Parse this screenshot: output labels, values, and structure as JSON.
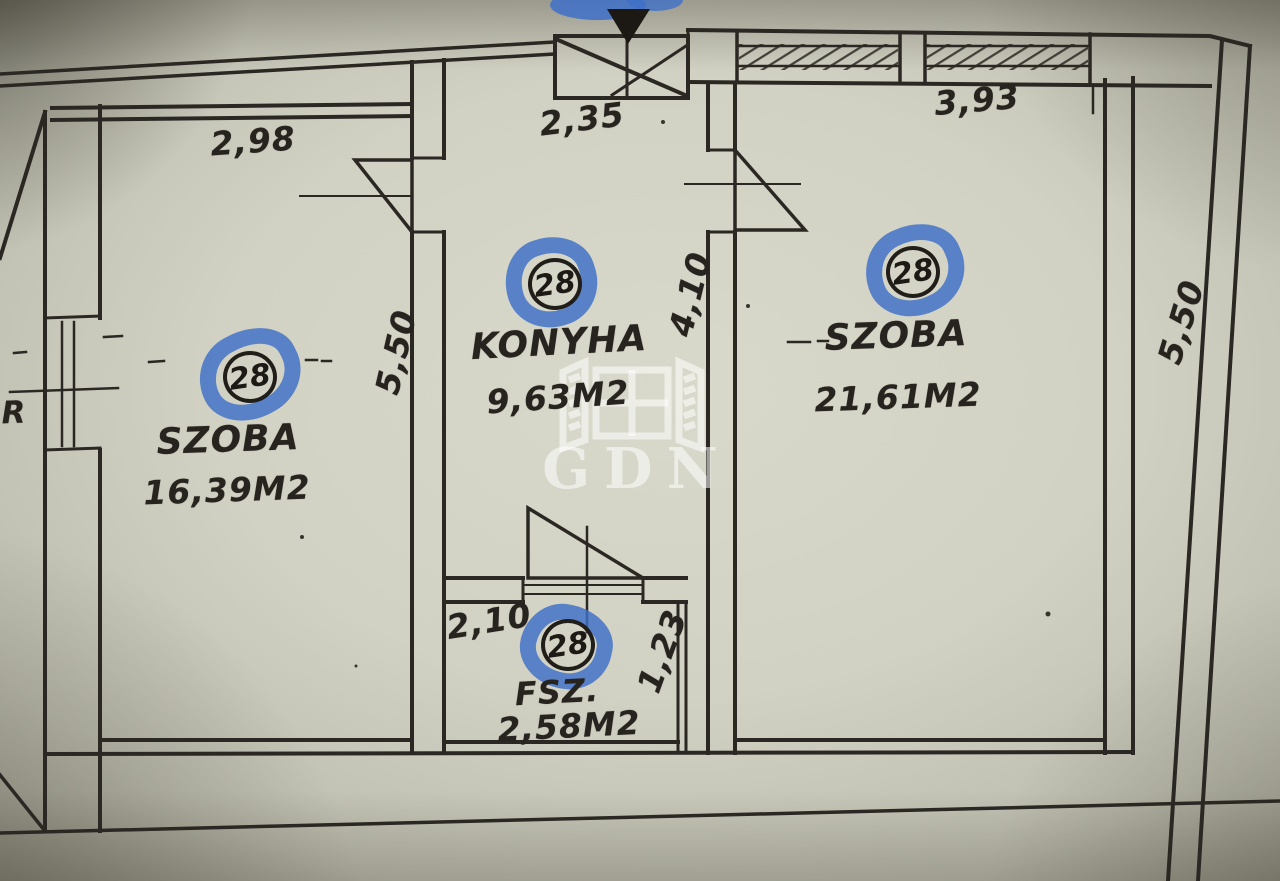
{
  "photo": {
    "type": "floor-plan",
    "annotation_color": "#3e70c8",
    "unit_number": "28",
    "rooms": [
      {
        "name": "SZOBA",
        "area": "16,39M2",
        "badge": "28"
      },
      {
        "name": "KONYHA",
        "area": "9,63M2",
        "badge": "28"
      },
      {
        "name": "SZOBA",
        "area": "21,61M2",
        "badge": "28"
      },
      {
        "name": "FSZ.",
        "area": "2,58M2",
        "badge": "28"
      }
    ],
    "dimensions": {
      "left_room_width": "2,98",
      "left_room_depth": "5,50",
      "kitchen_width": "2,35",
      "kitchen_depth": "4,10",
      "right_room_width": "3,93",
      "right_room_depth": "5,50",
      "fsz_width": "2,10",
      "fsz_depth": "1,23",
      "left_margin_label": "R"
    },
    "watermark": {
      "brand": "GDN",
      "icon": "open-window-icon"
    }
  }
}
